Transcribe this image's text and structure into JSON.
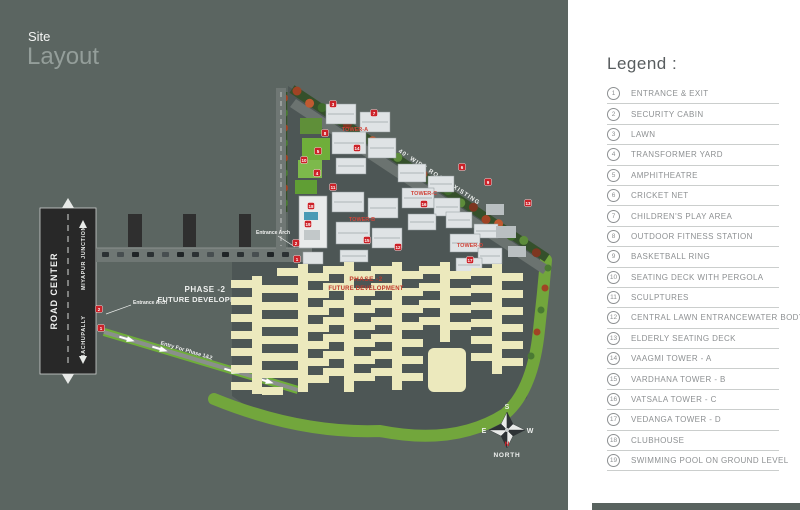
{
  "title": {
    "line1": "Site",
    "line2": "Layout"
  },
  "map": {
    "labels": {
      "road_center": "ROAD CENTER",
      "junction_up": "MIYAPUR JUNCTION",
      "junction_down": "BACHUPALLY",
      "entrance_arch_left": "Entrance Arch",
      "entrance_arch_right": "Entrance Arch",
      "entry_road": "Entry For Phase 1&2",
      "top_road": "40' WIDE ROAD EXISTING",
      "phase2_left_line1": "PHASE -2",
      "phase2_left_line2": "FUTURE DEVELOPMENT",
      "phase2_red_line1": "PHASE -2",
      "phase2_red_line2": "FUTURE DEVELOPMENT"
    },
    "towers": [
      "TOWER-A",
      "TOWER-B",
      "TOWER-C",
      "TOWER-D"
    ],
    "compass": {
      "n": "N",
      "s": "S",
      "e": "E",
      "w": "W",
      "label": "NORTH"
    },
    "markers": [
      {
        "num": "2",
        "x": 99,
        "y": 309
      },
      {
        "num": "1",
        "x": 101,
        "y": 328
      },
      {
        "num": "2",
        "x": 296,
        "y": 243
      },
      {
        "num": "1",
        "x": 297,
        "y": 259
      },
      {
        "num": "3",
        "x": 333,
        "y": 104
      },
      {
        "num": "7",
        "x": 374,
        "y": 113
      },
      {
        "num": "8",
        "x": 325,
        "y": 133
      },
      {
        "num": "5",
        "x": 318,
        "y": 151
      },
      {
        "num": "10",
        "x": 304,
        "y": 160
      },
      {
        "num": "4",
        "x": 317,
        "y": 173
      },
      {
        "num": "11",
        "x": 333,
        "y": 187
      },
      {
        "num": "6",
        "x": 462,
        "y": 167
      },
      {
        "num": "9",
        "x": 488,
        "y": 182
      },
      {
        "num": "13",
        "x": 528,
        "y": 203
      },
      {
        "num": "12",
        "x": 398,
        "y": 247
      },
      {
        "num": "14",
        "x": 357,
        "y": 148
      },
      {
        "num": "15",
        "x": 367,
        "y": 240
      },
      {
        "num": "16",
        "x": 424,
        "y": 204
      },
      {
        "num": "17",
        "x": 470,
        "y": 260
      },
      {
        "num": "18",
        "x": 311,
        "y": 206
      },
      {
        "num": "19",
        "x": 308,
        "y": 224
      }
    ],
    "colors": {
      "map_bg": "#5b6561",
      "marker_red": "#cc2229",
      "tower_text": "#d0453a",
      "phase2_yellow": "#ece9bd",
      "lawn_green": "#72a63c",
      "ground": "#4d5655"
    }
  },
  "legend": {
    "title": "Legend :",
    "items": [
      {
        "num": "1",
        "label": "ENTRANCE & EXIT"
      },
      {
        "num": "2",
        "label": "SECURITY CABIN"
      },
      {
        "num": "3",
        "label": "LAWN"
      },
      {
        "num": "4",
        "label": "TRANSFORMER YARD"
      },
      {
        "num": "5",
        "label": "AMPHITHEATRE"
      },
      {
        "num": "6",
        "label": "CRICKET NET"
      },
      {
        "num": "7",
        "label": "CHILDREN'S PLAY AREA"
      },
      {
        "num": "8",
        "label": "OUTDOOR FITNESS STATION"
      },
      {
        "num": "9",
        "label": "BASKETBALL RING"
      },
      {
        "num": "10",
        "label": "SEATING DECK WITH PERGOLA"
      },
      {
        "num": "11",
        "label": "SCULPTURES"
      },
      {
        "num": "12",
        "label": "CENTRAL LAWN ENTRANCEWATER BODY"
      },
      {
        "num": "13",
        "label": "ELDERLY SEATING DECK"
      },
      {
        "num": "14",
        "label": "VAAGMI TOWER - A"
      },
      {
        "num": "15",
        "label": "VARDHANA TOWER - B"
      },
      {
        "num": "16",
        "label": "VATSALA  TOWER - C"
      },
      {
        "num": "17",
        "label": "VEDANGA TOWER - D"
      },
      {
        "num": "18",
        "label": "CLUBHOUSE"
      },
      {
        "num": "19",
        "label": "SWIMMING POOL ON GROUND LEVEL"
      }
    ]
  }
}
